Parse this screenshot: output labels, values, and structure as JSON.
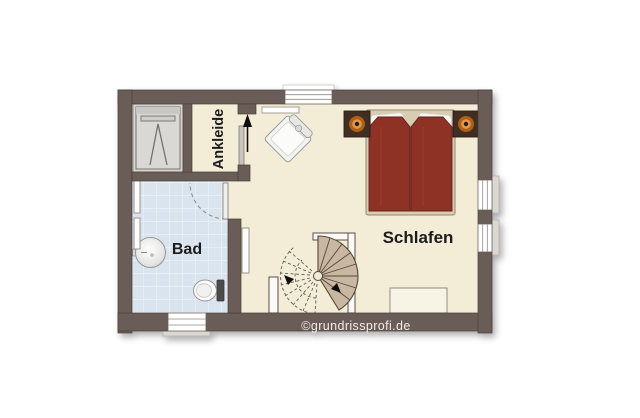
{
  "watermark": "©grundrissprofi.de",
  "rooms": {
    "bathroom": {
      "label": "Bad"
    },
    "bedroom": {
      "label": "Schlafen"
    },
    "dressing": {
      "label": "Ankleide"
    }
  },
  "furniture": [
    "wardrobe",
    "double-bed",
    "nightstand-left",
    "nightstand-right",
    "bedside-lamp-left",
    "bedside-lamp-right",
    "armchair",
    "spiral-staircase",
    "dresser",
    "washbasin",
    "toilet",
    "radiator",
    "windows",
    "door-swing"
  ],
  "colors": {
    "wall": "#6a5d58",
    "wall_outline": "#483e39",
    "floor": "#f3edd8",
    "tile": "#d9e4ef",
    "niche": "#d6d4d0",
    "bed_duvet": "#8e3126",
    "bed_frame": "#d8ccb2",
    "pillow": "#f6f5f1",
    "nightstand": "#3f2f23",
    "lamp_ring": "#b25e14",
    "lamp_glow": "#dd9a4f",
    "stair_tread": "#c8b8a2",
    "stair_outline": "#54463a",
    "watermark_text": "#efecea"
  }
}
